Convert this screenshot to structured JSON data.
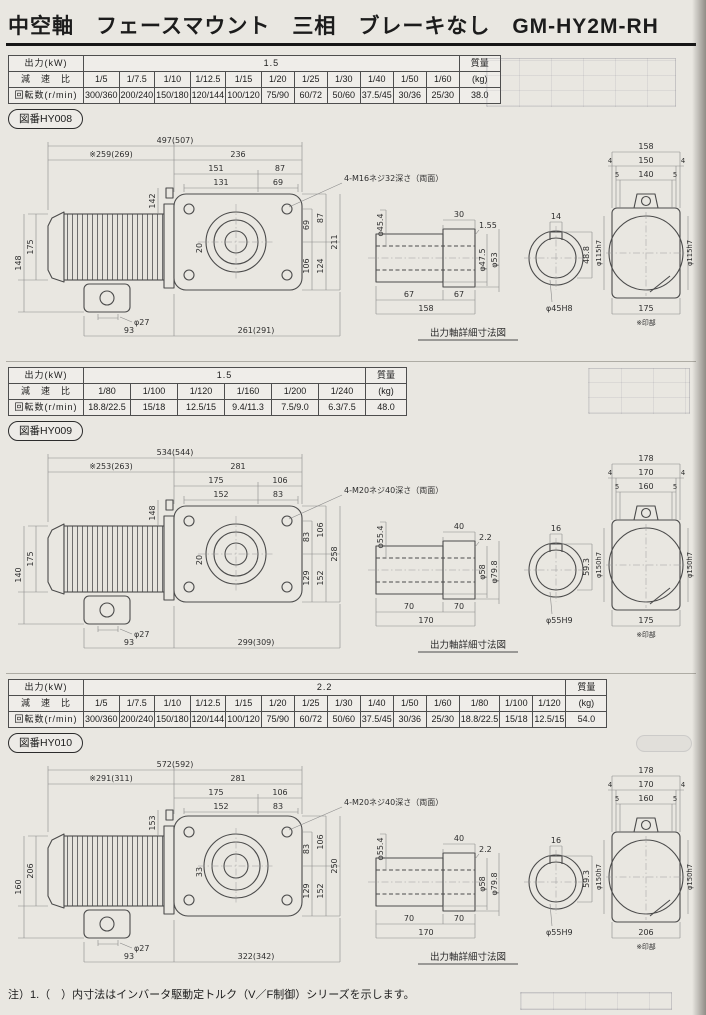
{
  "page": {
    "title": "中空軸　フェースマウント　三相　ブレーキなし　GM-HY2M-RH",
    "footnote": "注）1.（　）内寸法はインバータ駆動定トルク（V／F制御）シリーズを示します。"
  },
  "tables": [
    {
      "fig_label": "図番HY008",
      "row1_label": "出力(kW)",
      "row2_label": "減　速　比",
      "row3_label": "回転数(r/min)",
      "output": "1.5",
      "mass_label": "質量",
      "mass_unit": "(kg)",
      "mass": "38.0",
      "ratios": [
        "1/5",
        "1/7.5",
        "1/10",
        "1/12.5",
        "1/15",
        "1/20",
        "1/25",
        "1/30",
        "1/40",
        "1/50",
        "1/60"
      ],
      "speeds": [
        "300/360",
        "200/240",
        "150/180",
        "120/144",
        "100/120",
        "75/90",
        "60/72",
        "50/60",
        "37.5/45",
        "30/36",
        "25/30"
      ]
    },
    {
      "fig_label": "図番HY009",
      "row1_label": "出力(kW)",
      "row2_label": "減　速　比",
      "row3_label": "回転数(r/min)",
      "output": "1.5",
      "mass_label": "質量",
      "mass_unit": "(kg)",
      "mass": "48.0",
      "ratios": [
        "1/80",
        "1/100",
        "1/120",
        "1/160",
        "1/200",
        "1/240"
      ],
      "speeds": [
        "18.8/22.5",
        "15/18",
        "12.5/15",
        "9.4/11.3",
        "7.5/9.0",
        "6.3/7.5"
      ]
    },
    {
      "fig_label": "図番HY010",
      "row1_label": "出力(kW)",
      "row2_label": "減　速　比",
      "row3_label": "回転数(r/min)",
      "output": "2.2",
      "mass_label": "質量",
      "mass_unit": "(kg)",
      "mass": "54.0",
      "ratios": [
        "1/5",
        "1/7.5",
        "1/10",
        "1/12.5",
        "1/15",
        "1/20",
        "1/25",
        "1/30",
        "1/40",
        "1/50",
        "1/60",
        "1/80",
        "1/100",
        "1/120"
      ],
      "speeds": [
        "300/360",
        "200/240",
        "150/180",
        "120/144",
        "100/120",
        "75/90",
        "60/72",
        "50/60",
        "37.5/45",
        "30/36",
        "25/30",
        "18.8/22.5",
        "15/18",
        "12.5/15"
      ]
    }
  ],
  "drawings": [
    {
      "screw_note": "4-M16ネジ32深さ（両面）",
      "caption": "出力軸詳細寸法図",
      "front": {
        "total": "497(507)",
        "motor": "※259(269)",
        "case_w": "236",
        "c1": "151",
        "c2": "87",
        "h1": "131",
        "h2": "69",
        "fin": "142",
        "l1": "175",
        "l2": "148",
        "inner": "20",
        "r1": "69",
        "r2": "87",
        "r3": "106",
        "r4": "124",
        "r5": "211",
        "shaft_d": "φ27",
        "b1": "93",
        "b2": "261(291)"
      },
      "shaft": {
        "collar_w": "30",
        "step": "1.55",
        "d1": "φ45.4",
        "d2": "φ47.5",
        "d3": "φ53",
        "s1": "67",
        "s2": "67",
        "total": "158",
        "key_w": "14",
        "key_h": "48.8",
        "bore": "φ45H8"
      },
      "side": {
        "w1": "158",
        "w2": "150",
        "w3": "140",
        "e1": "4",
        "e2": "4",
        "e3": "5",
        "e4": "5",
        "fit_l": "φ115h7",
        "fit_r": "φ115h7",
        "bottom": "175",
        "note": "※印部"
      }
    },
    {
      "screw_note": "4-M20ネジ40深さ（両面）",
      "caption": "出力軸詳細寸法図",
      "front": {
        "total": "534(544)",
        "motor": "※253(263)",
        "case_w": "281",
        "c1": "175",
        "c2": "106",
        "h1": "152",
        "h2": "83",
        "fin": "148",
        "l1": "175",
        "l2": "140",
        "inner": "20",
        "r1": "83",
        "r2": "106",
        "r3": "129",
        "r4": "152",
        "r5": "258",
        "shaft_d": "φ27",
        "b1": "93",
        "b2": "299(309)"
      },
      "shaft": {
        "collar_w": "40",
        "step": "2.2",
        "d1": "φ55.4",
        "d2": "φ58",
        "d3": "φ79.8",
        "s1": "70",
        "s2": "70",
        "total": "170",
        "key_w": "16",
        "key_h": "59.3",
        "bore": "φ55H9"
      },
      "side": {
        "w1": "178",
        "w2": "170",
        "w3": "160",
        "e1": "4",
        "e2": "4",
        "e3": "5",
        "e4": "5",
        "fit_l": "φ150h7",
        "fit_r": "φ150h7",
        "bottom": "175",
        "note": "※印部"
      }
    },
    {
      "screw_note": "4-M20ネジ40深さ（両面）",
      "caption": "出力軸詳細寸法図",
      "front": {
        "total": "572(592)",
        "motor": "※291(311)",
        "case_w": "281",
        "c1": "175",
        "c2": "106",
        "h1": "152",
        "h2": "83",
        "fin": "153",
        "l1": "206",
        "l2": "160",
        "inner": "33",
        "r1": "83",
        "r2": "106",
        "r3": "129",
        "r4": "152",
        "r5": "250",
        "shaft_d": "φ27",
        "b1": "93",
        "b2": "322(342)"
      },
      "shaft": {
        "collar_w": "40",
        "step": "2.2",
        "d1": "φ55.4",
        "d2": "φ58",
        "d3": "φ79.8",
        "s1": "70",
        "s2": "70",
        "total": "170",
        "key_w": "16",
        "key_h": "59.3",
        "bore": "φ55H9"
      },
      "side": {
        "w1": "178",
        "w2": "170",
        "w3": "160",
        "e1": "4",
        "e2": "4",
        "e3": "5",
        "e4": "5",
        "fit_l": "φ150h7",
        "fit_r": "φ150h7",
        "bottom": "206",
        "note": "※印部"
      }
    }
  ]
}
